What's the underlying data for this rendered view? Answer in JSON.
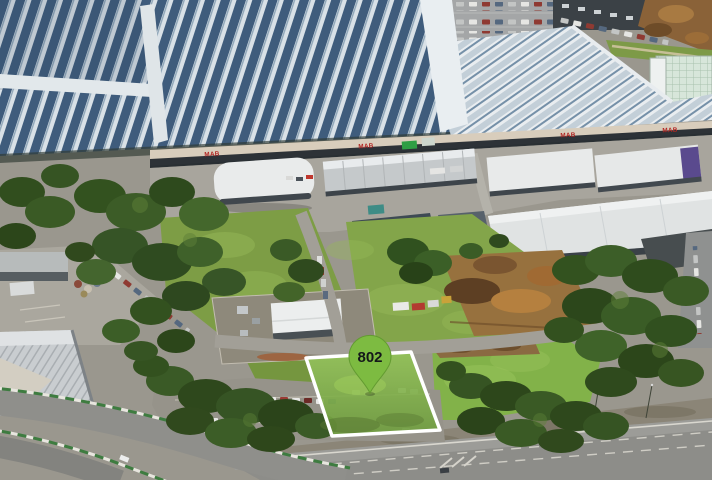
{
  "scene": {
    "kind": "aerial-photograph",
    "caption": "Aerial view of an industrial estate beside a highway, with a vacant development lot outlined in white"
  },
  "lot_marker": {
    "label": "802"
  },
  "building_signs": {
    "mab": "MAB"
  },
  "palette": {
    "pin_green": "#7dbb41",
    "lot_outline": "#ffffff",
    "sign_red": "#b22623",
    "solar_roof_blue": "#3f5c7c",
    "grass_green": "#7d9d45",
    "tree_green": "#33521f",
    "road_grey": "#95958f"
  }
}
